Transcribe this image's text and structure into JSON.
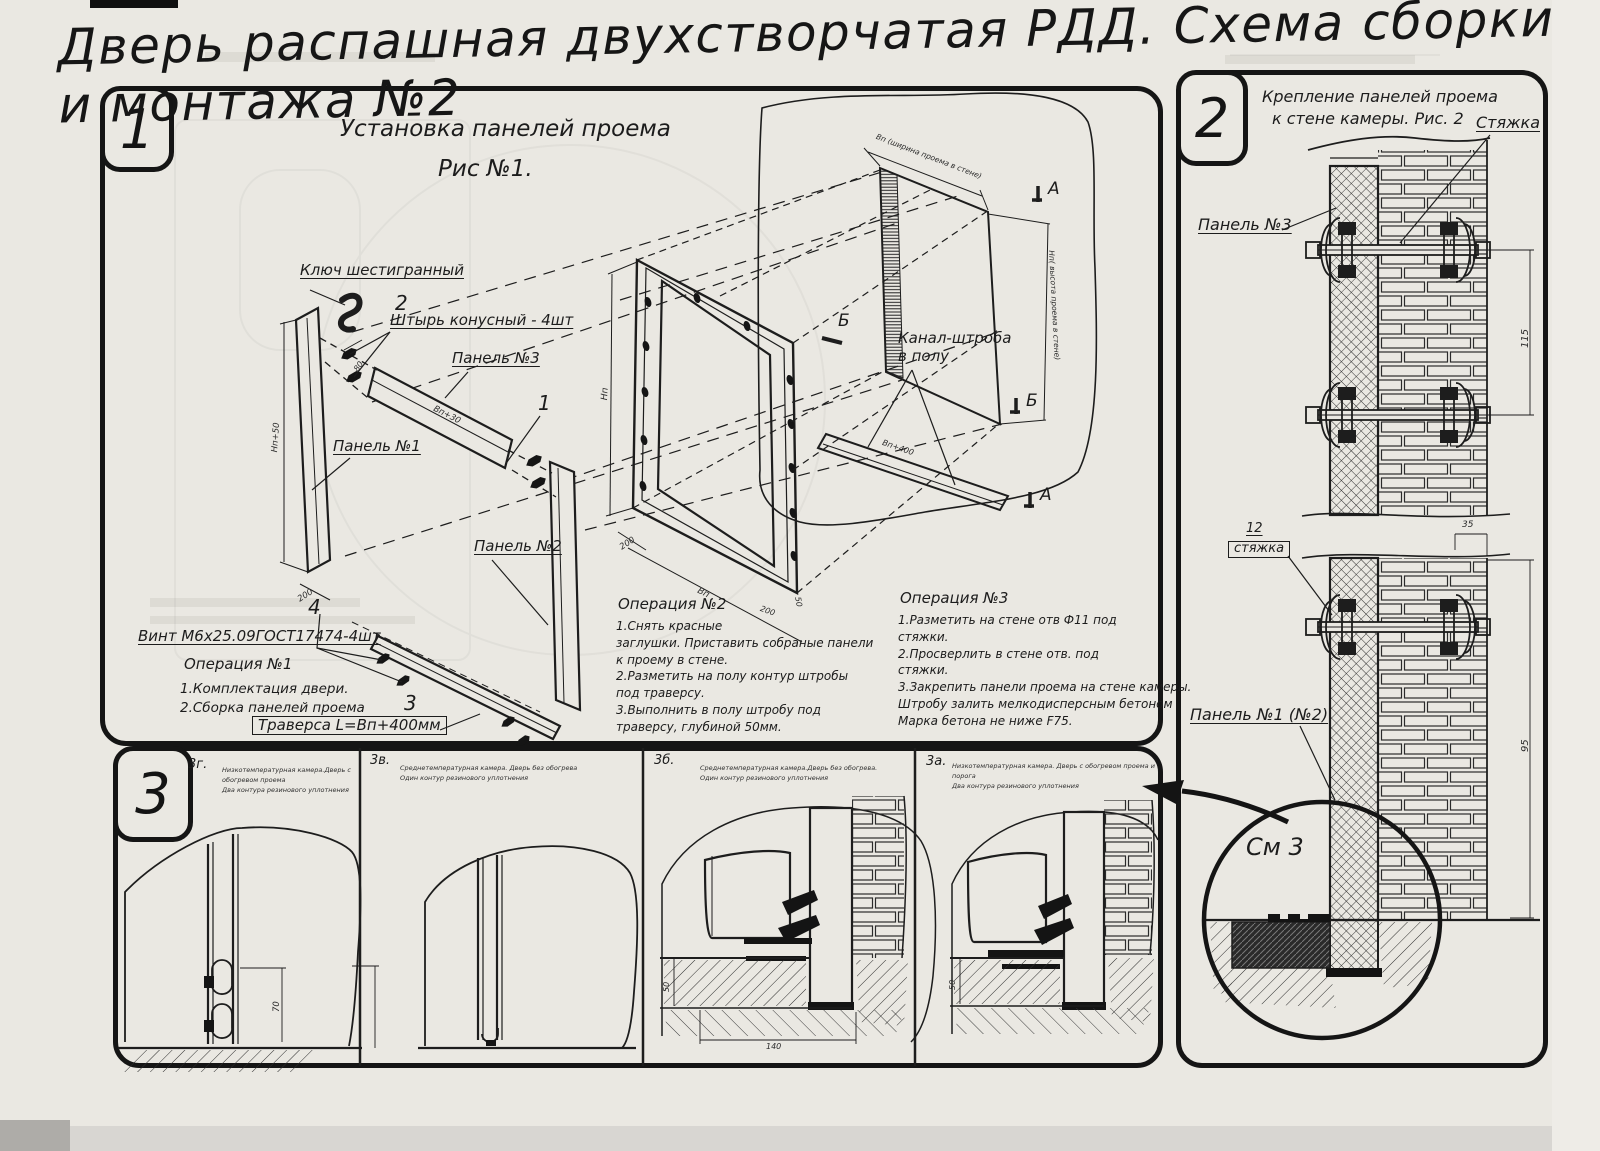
{
  "page": {
    "title": "Дверь распашная двухстворчатая РДД.  Схема сборки и монтажа №2"
  },
  "section1": {
    "badge": "1",
    "fig_title_line1": "Установка панелей проема",
    "fig_title_line2": "Рис №1.",
    "labels": {
      "hex_key": "Ключ шестигранный",
      "pin": "Штырь конусный - 4шт",
      "panel3": "Панель №3",
      "panel1": "Панель №1",
      "panel2": "Панель №2",
      "screw": "Винт М6х25.09ГОСТ17474-4шт",
      "traverse": "Траверса  L=Вп+400мм",
      "channel_line1": "Канал-штроба",
      "channel_line2": "в полу",
      "callout_1": "1",
      "callout_2": "2",
      "callout_3": "3",
      "callout_4": "4",
      "marker_a": "А",
      "marker_b": "Б"
    },
    "dims": {
      "np50": "Нп+50",
      "d200": "200",
      "vp30": "Вп+30",
      "d80": "80",
      "np": "Нп",
      "vp": "Вп",
      "vp400": "Вп+400",
      "d50": "50",
      "opening_width": "Вп (ширина проема в стене)",
      "opening_height": "Нп( высота проема в стене)"
    },
    "operation1": {
      "title": "Операция №1",
      "body": "1.Комплектация двери.\n2.Сборка панелей проема"
    },
    "operation2": {
      "title": "Операция №2",
      "body": "1.Снять красные\nзаглушки. Приставить собраные панели\nк проему в стене.\n2.Разметить на полу контур штробы\nпод траверсу.\n3.Выполнить в полу штробу под\nтраверсу, глубиной 50мм."
    },
    "operation3": {
      "title": "Операция №3",
      "body": "1.Разметить на стене отв Ф11 под\nстяжки.\n2.Просверлить в стене отв.  под\nстяжки.\n3.Закрепить панели проема на стене камеры.\nШтробу залить мелкодисперсным бетоном\nМарка бетона не ниже  F75."
    }
  },
  "section2": {
    "badge": "2",
    "fig_title_line1": "Крепление панелей проема",
    "fig_title_line2": "к стене камеры. Рис. 2",
    "labels": {
      "tie": "Стяжка",
      "panel3": "Панель №3",
      "tie_no": "12",
      "tie_word": "стяжка",
      "panel12": "Панель №1 (№2)",
      "see3": "См 3"
    },
    "dims": {
      "d115": "115",
      "d35": "35",
      "d95": "95"
    }
  },
  "section3": {
    "badge": "3",
    "subsections": [
      {
        "id": "3г.",
        "caption": "Низкотемпературная камера.Дверь с обогревом проема\nДва контура резинового уплотнения"
      },
      {
        "id": "3в.",
        "caption": "Среднетемпературная камера. Дверь без обогрева\nОдин контур резинового уплотнения"
      },
      {
        "id": "3б.",
        "caption": "Среднетемпературная камера.Дверь без обогрева.\nОдин контур резинового уплотнения"
      },
      {
        "id": "3а.",
        "caption": "Низкотемпературная камера. Дверь с обогревом проема и порога\nДва контура резинового уплотнения"
      }
    ],
    "dims": {
      "d70": "70",
      "d50": "50",
      "d140": "140"
    }
  }
}
